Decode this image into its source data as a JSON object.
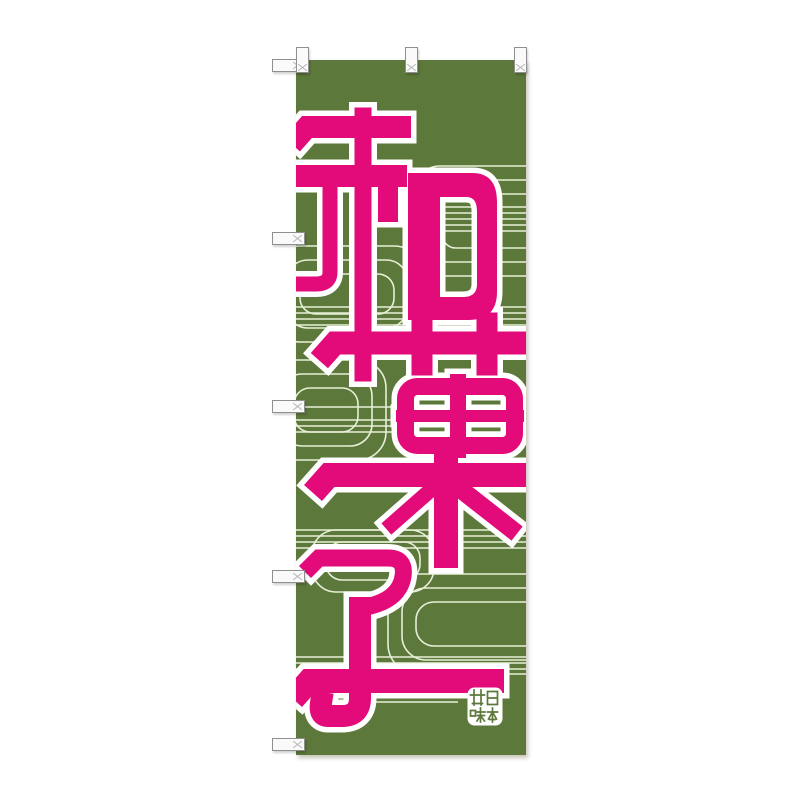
{
  "page": {
    "background_color": "#ffffff"
  },
  "banner": {
    "text": "和菓子",
    "characters": [
      "和",
      "菓",
      "子"
    ],
    "writing_direction": "vertical-top-to-bottom",
    "fabric_color": "#5c783a",
    "text_color": "#e20b79",
    "text_outline_color": "#ffffff",
    "pattern_line_color": "#e8efd8",
    "pattern_motif": "flowing-water nested rounded rectangles and horizontal lines",
    "tabs": {
      "top_count": 3,
      "left_count": 5,
      "fill": "#fafafa",
      "border": "#8f8f8f"
    }
  },
  "seal": {
    "text": "日本甘味",
    "characters": [
      "日",
      "本",
      "甘",
      "味"
    ],
    "background": "#ffffff",
    "glyph_color": "#5c783a"
  }
}
